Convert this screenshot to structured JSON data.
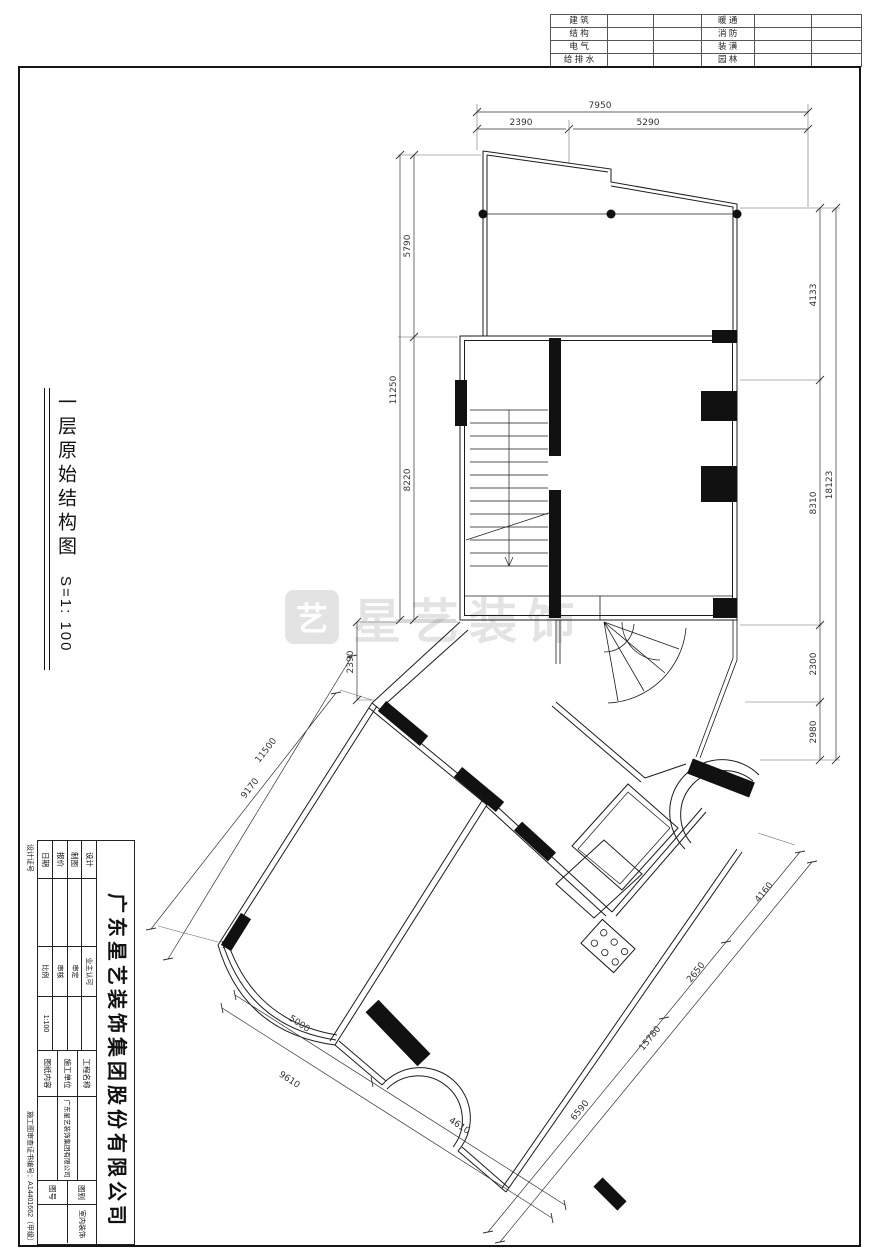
{
  "top_strip": {
    "left": [
      "建 筑",
      "结 构",
      "电 气",
      "给 排 水"
    ],
    "right": [
      "暖 通",
      "消 防",
      "装 潢",
      "园 林"
    ]
  },
  "side_title": {
    "text": "一层原始结构图",
    "scale": "S=1: 100"
  },
  "watermark": {
    "logo_glyph": "艺",
    "text": "星艺装饰"
  },
  "dims": {
    "top_total": "7950",
    "top_a": "2390",
    "top_b": "5290",
    "left_total": "11250",
    "left_a": "5790",
    "left_b": "8220",
    "right_total": "18123",
    "right_a": "4133",
    "right_b": "8310",
    "right_c": "2300",
    "right_d": "2980",
    "mid_v": "2390",
    "diag_nw_outer": "11500",
    "diag_nw_inner": "9170",
    "diag_sw_a": "5000",
    "diag_sw_total": "9610",
    "diag_sw_b": "4610",
    "diag_se_a": "4160",
    "diag_se_b": "2650",
    "diag_se_c": "6590",
    "diag_se_total": "15780"
  },
  "title_block": {
    "company": "广东星艺装饰集团股份有限公司",
    "col_a": [
      "设计",
      "制图",
      "报价",
      "日期"
    ],
    "col_b": [
      {
        "label": "业主认可",
        "value": ""
      },
      {
        "label": "审定",
        "value": ""
      },
      {
        "label": "审核",
        "value": ""
      },
      {
        "label": "比例",
        "value": "1:100"
      }
    ],
    "col_c": [
      {
        "label": "工程名称",
        "value": ""
      },
      {
        "label": "施工单位",
        "value": "广东星艺装饰集团有限公司"
      },
      {
        "label": "图纸内容",
        "value": ""
      }
    ],
    "col_d": [
      {
        "label": "图别",
        "value": "室内装饰"
      },
      {
        "label": "图号",
        "value": ""
      }
    ],
    "cert_label": "设计证号",
    "cert_no": "施工图审查证书编号：A14401662（甲级）"
  }
}
